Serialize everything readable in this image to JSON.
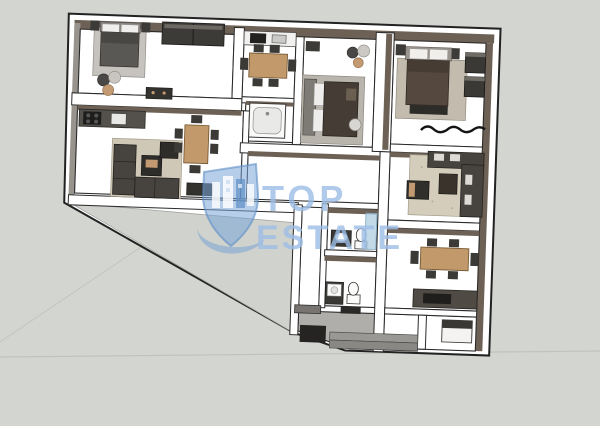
{
  "scene": {
    "type": "3d-floor-plan-render",
    "background_color": "#d3d5d1",
    "description": "Top-down 3D render of an apartment floor plan with furniture, real-estate listing watermark"
  },
  "watermark": {
    "line1": "TOP",
    "line2": "ESTATE",
    "color": "#9cbde6",
    "logo": "building-location-pin-with-swoosh"
  },
  "palette": {
    "background": "#d3d5d1",
    "wall_face_taupe": "#6d6156",
    "wall_face_gray": "#98938c",
    "wall_white": "#ffffff",
    "outline": "#222222",
    "floor_white": "#ffffff",
    "terrace_gray": "#d0d2ce",
    "entry_floor": "#b0aeaa",
    "furniture_dark": "#3d3b38",
    "wood": "#c2996a",
    "rug_beige": "#d2cab8",
    "rug_gray": "#c6c3be",
    "glass_blue": "#aecde0",
    "watermark_blue": "#9cbde6"
  },
  "rooms": [
    {
      "name": "bedroom-left",
      "furniture": [
        "double-bed",
        "nightstand",
        "nightstand",
        "wardrobe",
        "rug",
        "pouf-set",
        "dresser"
      ]
    },
    {
      "name": "living-kitchen-left",
      "furniture": [
        "kitchen-counter",
        "stove",
        "sink",
        "corner-sofa",
        "coffee-table",
        "desk-chair",
        "dining-table",
        "chairs",
        "tv-stand",
        "rug"
      ]
    },
    {
      "name": "kitchen-middle",
      "furniture": [
        "kitchen-counter",
        "stove",
        "sink",
        "dining-table",
        "chairs"
      ]
    },
    {
      "name": "bathroom-middle-top",
      "furniture": [
        "bathtub"
      ]
    },
    {
      "name": "bedroom-middle",
      "furniture": [
        "double-bed",
        "rug",
        "wall-shelf",
        "pouf-set",
        "side-stool"
      ]
    },
    {
      "name": "hallway",
      "furniture": []
    },
    {
      "name": "terrace",
      "furniture": []
    },
    {
      "name": "bathroom-upper",
      "furniture": [
        "vanity-sink",
        "toilet",
        "shower-glass"
      ]
    },
    {
      "name": "bathroom-lower",
      "furniture": [
        "sink",
        "toilet"
      ]
    },
    {
      "name": "entrance",
      "furniture": [
        "door-mat",
        "steps"
      ]
    },
    {
      "name": "bedroom-right",
      "furniture": [
        "double-bed",
        "nightstand",
        "nightstand",
        "wall-wardrobe",
        "rug",
        "foot-bench",
        "decor-squiggle"
      ]
    },
    {
      "name": "living-right",
      "furniture": [
        "corner-sofa",
        "coffee-table",
        "tv-unit",
        "rug"
      ]
    },
    {
      "name": "dining-right",
      "furniture": [
        "dining-table",
        "chairs"
      ]
    },
    {
      "name": "kitchen-right",
      "furniture": [
        "kitchen-counter",
        "sink",
        "corner-cabinet"
      ]
    }
  ]
}
